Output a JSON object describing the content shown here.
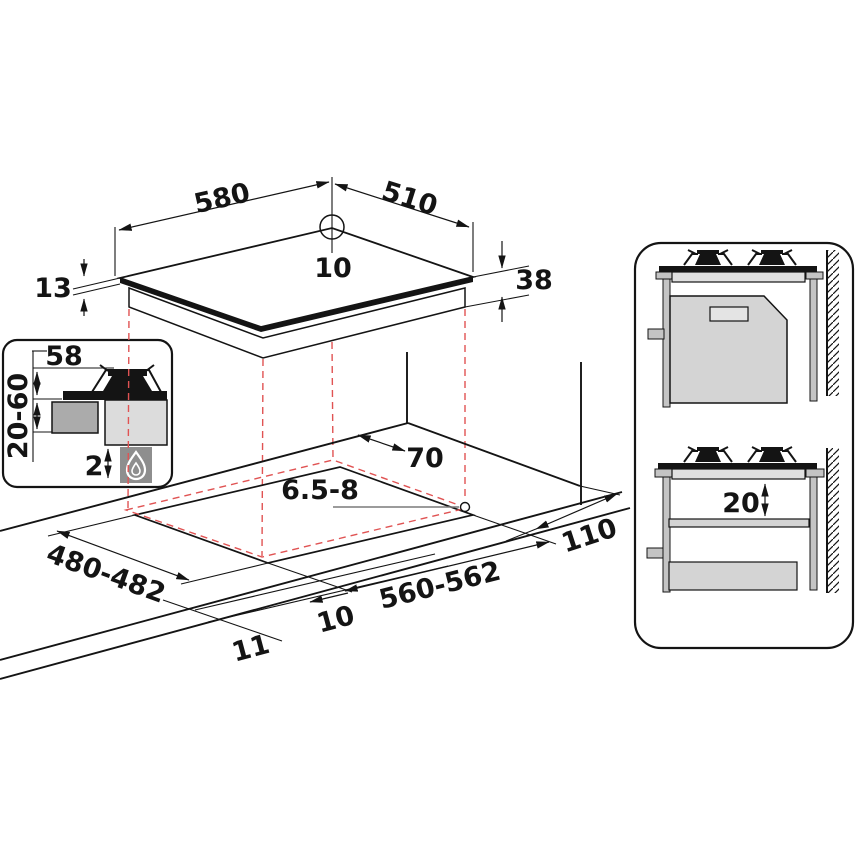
{
  "diagram_title": "Gas hob installation dimensions",
  "colors": {
    "line": "#141414",
    "projection_red": "#e05353",
    "gray_light": "#e0e0e0",
    "gray_mid": "#c4c4c4",
    "gray_body": "#d4d4d4",
    "gray_dark": "#8e8e8e"
  },
  "hob_top_view": {
    "width_mm": "580",
    "depth_mm": "510",
    "rear_connection_offset_mm": "10",
    "glass_edge_height_mm": "13",
    "body_height_mm": "38"
  },
  "burner_inset": {
    "burner_center_clearance_mm": "58",
    "clearance_below_range_mm": "20-60",
    "bottom_gap_mm": "2"
  },
  "worktop": {
    "rear_wall_clearance_mm": "70",
    "worktop_thickness_mm": "6.5-8",
    "cutout_depth_mm": "480-482",
    "cutout_width_mm": "560-562",
    "side_wall_clearance_mm": "110",
    "front_overhang_mm": "10",
    "side_overhang_mm": "11"
  },
  "section_views": {
    "shelf_clearance_mm": "20"
  }
}
